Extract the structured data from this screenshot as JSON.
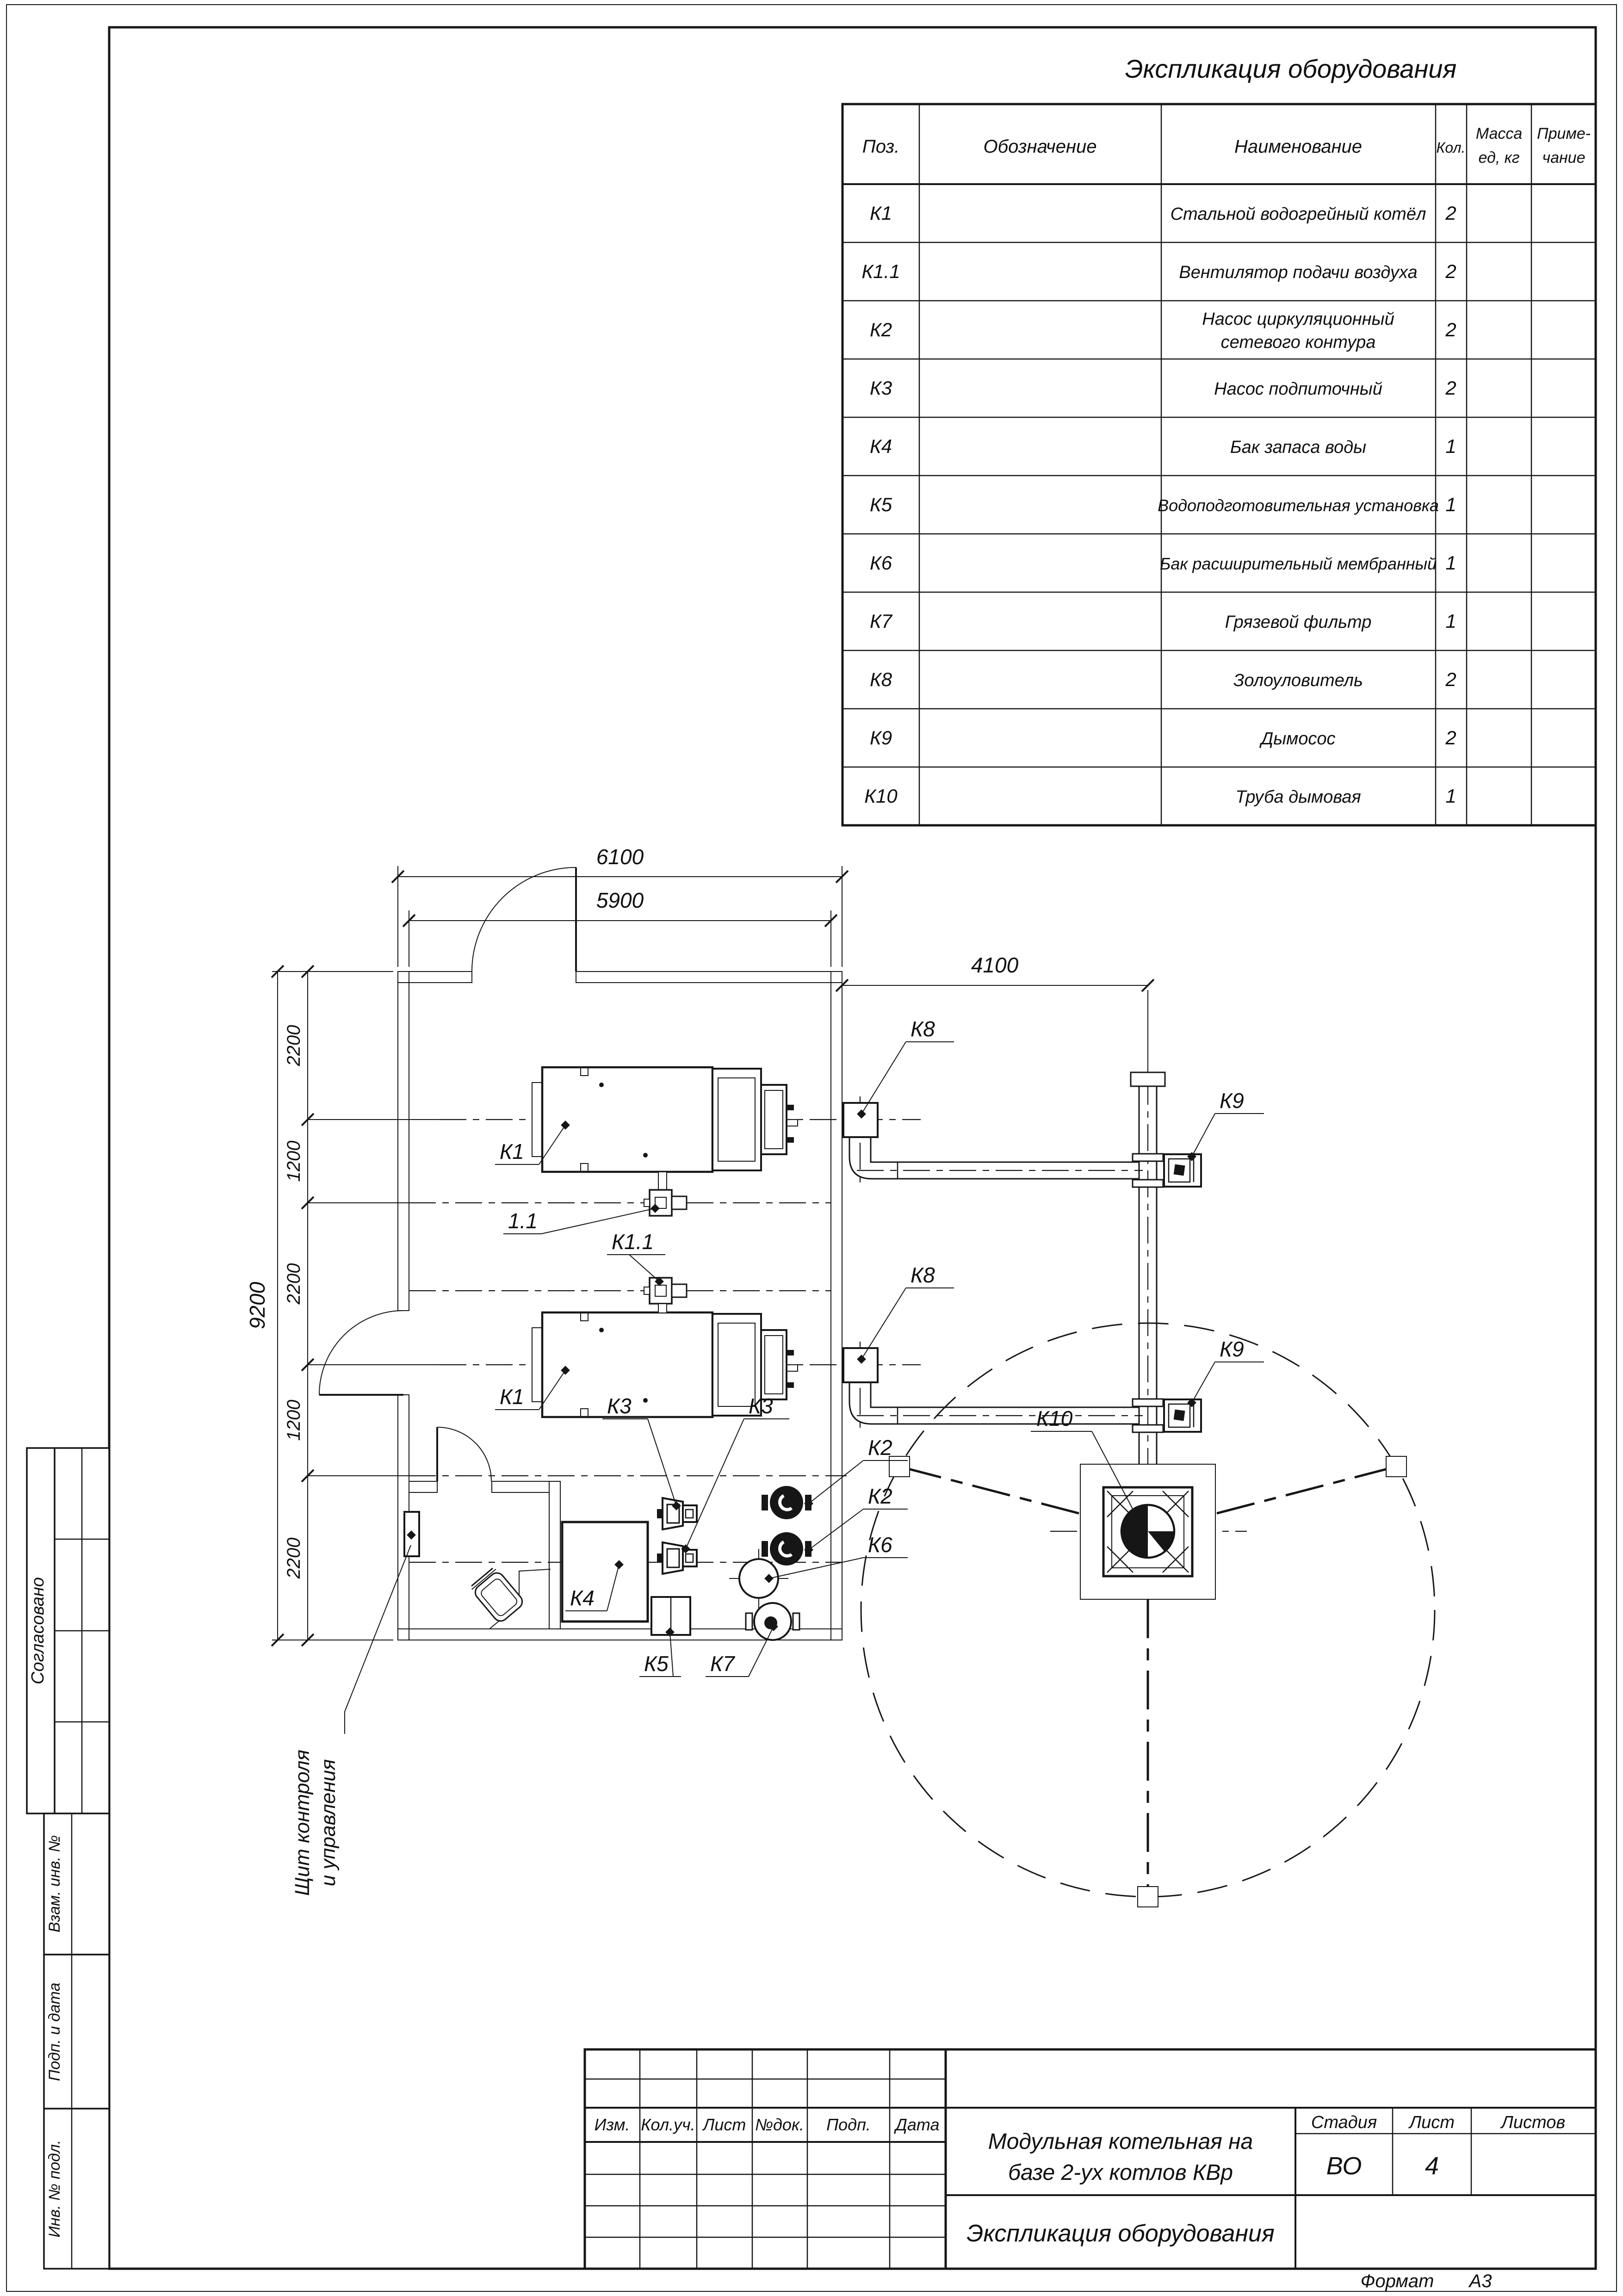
{
  "table": {
    "title": "Экспликация оборудования",
    "headers": {
      "pos": "Поз.",
      "designation": "Обозначение",
      "name": "Наименование",
      "qty": "Кол.",
      "mass_line1": "Масса",
      "mass_line2": "ед, кг",
      "note_line1": "Приме-",
      "note_line2": "чание"
    },
    "rows": [
      {
        "pos": "К1",
        "name": "Стальной водогрейный котёл",
        "qty": "2"
      },
      {
        "pos": "К1.1",
        "name": "Вентилятор подачи воздуха",
        "qty": "2"
      },
      {
        "pos": "К2",
        "name": "Насос циркуляционный",
        "name2": "сетевого контура",
        "qty": "2"
      },
      {
        "pos": "К3",
        "name": "Насос подпиточный",
        "qty": "2"
      },
      {
        "pos": "К4",
        "name": "Бак запаса воды",
        "qty": "1"
      },
      {
        "pos": "К5",
        "name": "Водоподготовительная установка",
        "qty": "1"
      },
      {
        "pos": "К6",
        "name": "Бак расширительный мембранный",
        "qty": "1"
      },
      {
        "pos": "К7",
        "name": "Грязевой фильтр",
        "qty": "1"
      },
      {
        "pos": "К8",
        "name": "Золоуловитель",
        "qty": "2"
      },
      {
        "pos": "К9",
        "name": "Дымосос",
        "qty": "2"
      },
      {
        "pos": "К10",
        "name": "Труба дымовая",
        "qty": "1"
      }
    ]
  },
  "plan": {
    "dims": {
      "width_outer": "6100",
      "width_inner": "5900",
      "to_chimney": "4100",
      "height": "9200",
      "chain": [
        "2200",
        "1200",
        "2200",
        "1200",
        "2200"
      ]
    },
    "labels": {
      "boiler1": "К1",
      "boiler2": "К1",
      "fan1": "1.1",
      "fan2": "К1.1",
      "ash1": "К8",
      "ash2": "К8",
      "smoke1": "К9",
      "smoke2": "К9",
      "chimney": "К10",
      "pump_net1": "К2",
      "pump_net2": "К2",
      "pump_feed1": "К3",
      "pump_feed2": "К3",
      "tank": "К4",
      "water_prep": "К5",
      "exp_tank": "К6",
      "filter": "К7"
    },
    "note_line1": "Щит контроля",
    "note_line2": "и управления"
  },
  "title_block": {
    "rev_headers": [
      "Изм.",
      "Кол.уч.",
      "Лист",
      "№док.",
      "Подп.",
      "Дата"
    ],
    "project_line1": "Модульная котельная на",
    "project_line2": "базе 2-ух котлов КВр",
    "stage_label": "Стадия",
    "sheet_label": "Лист",
    "sheets_label": "Листов",
    "stage_value": "ВО",
    "sheet_value": "4",
    "sheets_value": "",
    "doc_title": "Экспликация оборудования",
    "format_label": "Формат",
    "format_value": "А3"
  },
  "sidebar": {
    "agreed": "Согласовано",
    "subst_inv": "Взам. инв. №",
    "sign_date": "Подп. и дата",
    "inv_orig": "Инв. № подл."
  }
}
